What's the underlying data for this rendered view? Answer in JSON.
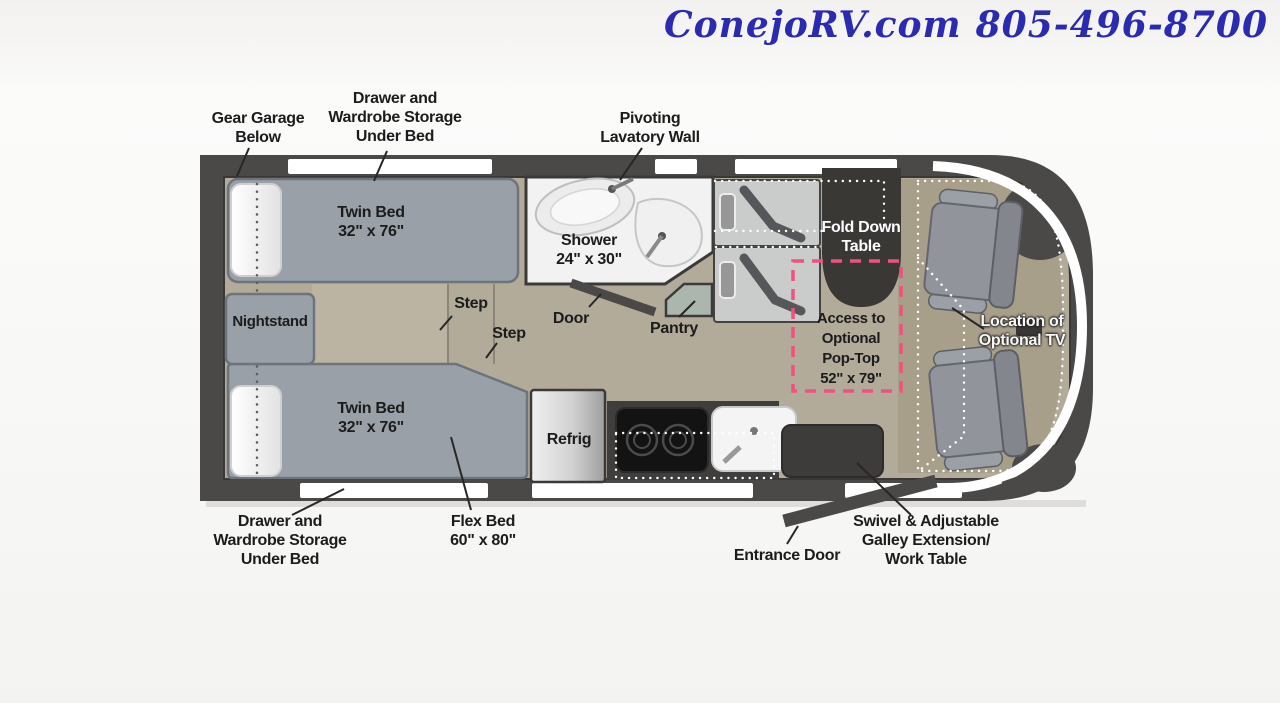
{
  "header": {
    "website": "ConejoRV.com",
    "phone": "805-496-8700"
  },
  "labels": {
    "gear_garage": [
      "Gear Garage",
      "Below"
    ],
    "drawer_storage_top": [
      "Drawer and",
      "Wardrobe Storage",
      "Under Bed"
    ],
    "pivoting_lavatory": [
      "Pivoting",
      "Lavatory Wall"
    ],
    "twin_bed_top": [
      "Twin Bed",
      "32\" x 76\""
    ],
    "shower": [
      "Shower",
      "24\" x 30\""
    ],
    "step_upper": "Step",
    "step_lower": "Step",
    "door": "Door",
    "pantry": "Pantry",
    "fold_down_table": [
      "Fold Down",
      "Table"
    ],
    "pop_top_access": [
      "Access to",
      "Optional",
      "Pop-Top",
      "52\" x 79\""
    ],
    "optional_tv": [
      "Location of",
      "Optional TV"
    ],
    "nightstand": "Nightstand",
    "twin_bed_bottom": [
      "Twin Bed",
      "32\" x 76\""
    ],
    "refrigerator": "Refrig",
    "drawer_storage_bottom": [
      "Drawer and",
      "Wardrobe Storage",
      "Under Bed"
    ],
    "flex_bed": [
      "Flex Bed",
      "60\" x 80\""
    ],
    "entrance_door": "Entrance Door",
    "galley_work_table": [
      "Swivel & Adjustable",
      "Galley Extension/",
      "Work Table"
    ]
  },
  "colors": {
    "wall": "#4b4947",
    "floor_tan": "#b3ab9a",
    "cab_floor": "#a89f8a",
    "bed_gray": "#9aa0a8",
    "pop_top_pink": "#f1517e",
    "header_blue": "#2b2bb2",
    "dotted_white": "#ffffff"
  }
}
